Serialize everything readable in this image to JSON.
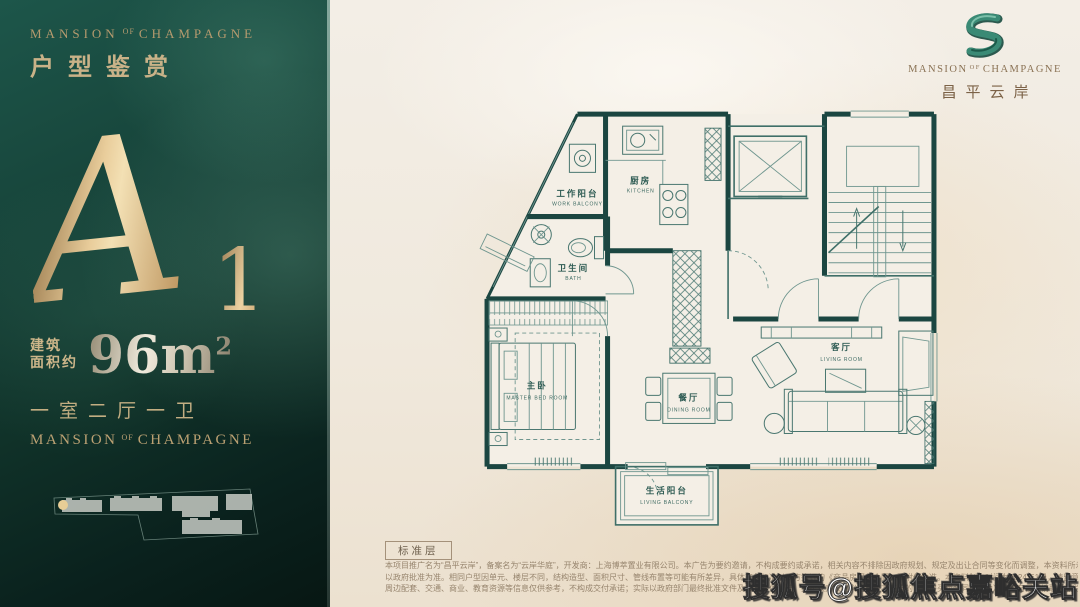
{
  "panel": {
    "brand": {
      "l": "MANSION",
      "of": "OF",
      "r": "CHAMPAGNE"
    },
    "title": "户型鉴赏",
    "unit_letter": "A",
    "unit_number": "1",
    "area": {
      "prefix1": "建筑",
      "prefix2": "面积约",
      "value": "96m",
      "sup": "2"
    },
    "layout": "一室二厅一卫",
    "brand_footer": {
      "l": "MANSION",
      "of": "OF",
      "r": "CHAMPAGNE"
    }
  },
  "logo": {
    "name": {
      "l": "MANSION",
      "of": "OF",
      "r": "CHAMPAGNE"
    },
    "cn": "昌平云岸"
  },
  "floorplan": {
    "level_tag": "标准层",
    "rooms": [
      {
        "zh": "工作阳台",
        "en": "WORK BALCONY"
      },
      {
        "zh": "厨房",
        "en": "KITCHEN"
      },
      {
        "zh": "卫生间",
        "en": "BATH"
      },
      {
        "zh": "主卧",
        "en": "MASTER BED ROOM"
      },
      {
        "zh": "餐厅",
        "en": "DINING ROOM"
      },
      {
        "zh": "客厅",
        "en": "LIVING ROOM"
      },
      {
        "zh": "生活阳台",
        "en": "LIVING BALCONY"
      }
    ]
  },
  "disclaimer": {
    "line1": "本项目推广名为“昌平云岸”，备案名为“云岸华庭”，开发商：上海博萃置业有限公司。本广告为要约邀请，不构成要约或承诺，相关内容不排除因政府规划、规定及出让合同等变化而调整，本资料所示户型平面图仅供参考。",
    "line2": "以政府批准为准。相同户型因单元、楼层不同，结构造型、面积尺寸、管线布置等可能有所差异，具体交付标准以双方签订的《商品房买卖合同》及附件为准。本资料制作时间为2024年1月，请留意最新资料，部分图片来源于网络。",
    "line3": "周边配套、交通、商业、教育资源等信息仅供参考，不构成交付承诺；实际以政府部门最终批准文件及实际交付为准。买卖双方权利义务以双方签署的商品房买卖合同约定为准，如有侵权请联系删除。"
  },
  "watermark": "搜狐号@搜狐焦点嘉峪关站",
  "colors": {
    "panel_green": "#17443a",
    "gold": "#c9a876",
    "silver": "#e8e2d4",
    "canvas_beige": "#f0e9dd",
    "wall_teal": "#1b4641",
    "line_teal": "#3f6f68",
    "logo_green": "#2e7b68",
    "watermark_white": "#ffffff"
  }
}
